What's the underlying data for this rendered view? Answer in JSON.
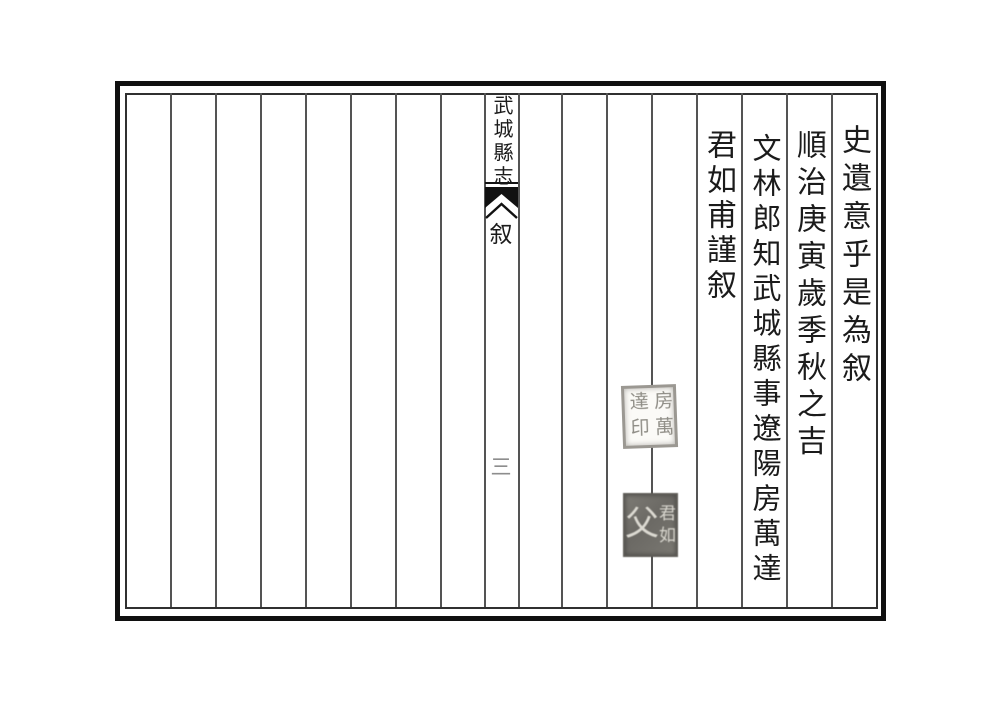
{
  "book": {
    "title": "武城縣志",
    "section": "叙",
    "page_number": "三"
  },
  "columns": [
    {
      "text": "史遺意乎是為叙"
    },
    {
      "text": "順治庚寅歲季秋之吉"
    },
    {
      "text": "文林郎知武城縣事遼陽房萬達"
    },
    {
      "text": "君如甫謹叙"
    }
  ],
  "seals": [
    {
      "right_chars": "房萬",
      "left_chars": "達印"
    },
    {
      "right_top": "君",
      "right_bottom": "如",
      "left_char": "父"
    }
  ],
  "colors": {
    "ink": "#1b1b1b",
    "outer_border": "#101010",
    "column_rule": "#545454",
    "page_number": "#8d8d8d",
    "seal_light_ink": "#8f8d86",
    "seal_dark_bg": "#6b6964"
  }
}
